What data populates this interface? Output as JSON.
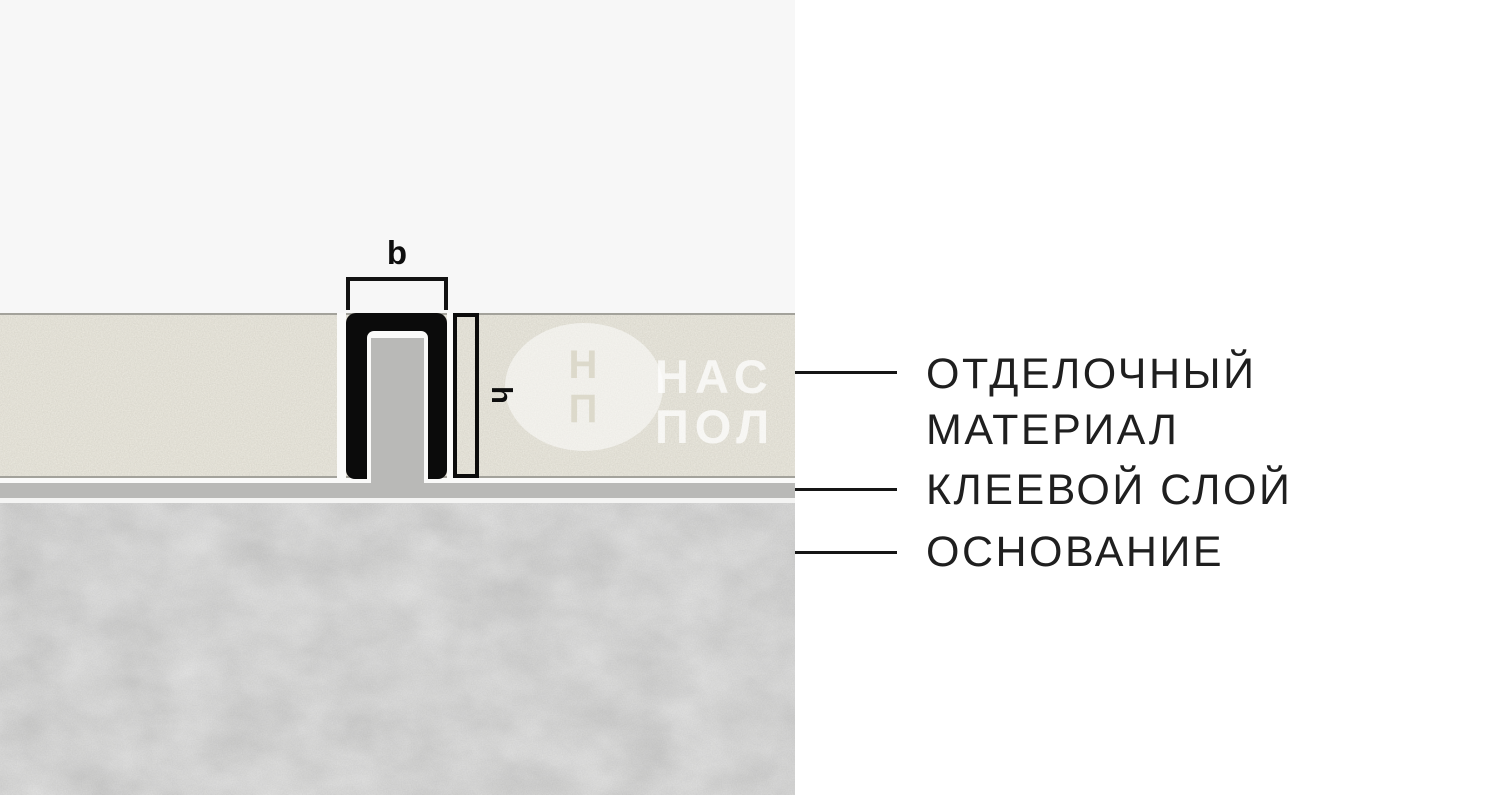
{
  "diagram": {
    "type": "flooring-profile-cross-section",
    "dimensions": {
      "width_label": "b",
      "height_label": "h"
    },
    "layers": {
      "finishing_material": {
        "label_line1": "ОТДЕЛОЧНЫЙ",
        "label_line2": "МАТЕРИАЛ",
        "color": "#e9e6da"
      },
      "adhesive": {
        "label": "КЛЕЕВОЙ СЛОЙ",
        "color": "#b9b9b7"
      },
      "base": {
        "label": "ОСНОВАНИЕ",
        "color": "#d5d5d4"
      }
    },
    "profile": {
      "color": "#0b0b0b",
      "joint_filler_color": "#b9b9b7"
    },
    "watermark": {
      "logo_line1": "Н",
      "logo_line2": "П",
      "text_line1": "НАС",
      "text_line2": "ПОЛ"
    },
    "background": {
      "panel_left": "#f7f7f7",
      "panel_right": "#ffffff"
    }
  }
}
